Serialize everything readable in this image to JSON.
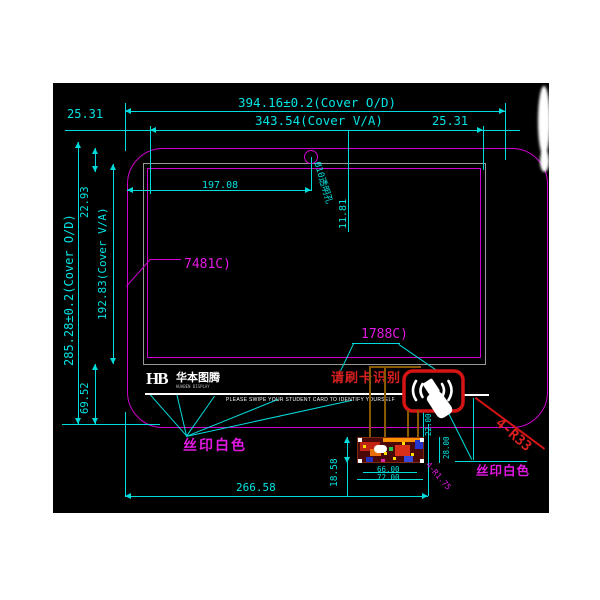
{
  "dims": {
    "cover_od_w": "394.16±0.2(Cover O/D)",
    "cover_va_w": "343.54(Cover  V/A)",
    "margin_l": "25.31",
    "margin_r": "25.31",
    "hole_x": "197.08",
    "hole_y": "11.81",
    "hole_label": "Ø10透明孔",
    "cover_od_h": "285.28±0.2(Cover O/D)",
    "gap_top": "22.93",
    "cover_va_h": "192.83(Cover V/A)",
    "gap_bottom": "69.52",
    "pcb_x": "266.58",
    "pcb_y": "18.58",
    "pcb_w_in": "66.00",
    "pcb_w_out": "72.00",
    "pcb_h_in": "22.00",
    "pcb_h_out": "28.00",
    "pcb_r": "4-R1.75",
    "cover_r": "4-R33"
  },
  "callouts": {
    "pantone_green": "7481C)",
    "pantone_red": "1788C)",
    "silk_left": "丝印白色",
    "silk_right": "丝印白色"
  },
  "brand": {
    "mark": "HB",
    "name": "华本图腾",
    "tagline": "HUABEN DISPLAY"
  },
  "notice": {
    "cn": "请刷卡识别",
    "en": "PLEASE SWIPE YOUR STUDENT CARD TO IDENTIFY YOURSELF"
  },
  "palette": {
    "cyan": "#00dcdc",
    "magenta": "#d400d4",
    "red": "#d31414",
    "gray": "#989898",
    "orange": "#8a5800",
    "black": "#000000"
  }
}
